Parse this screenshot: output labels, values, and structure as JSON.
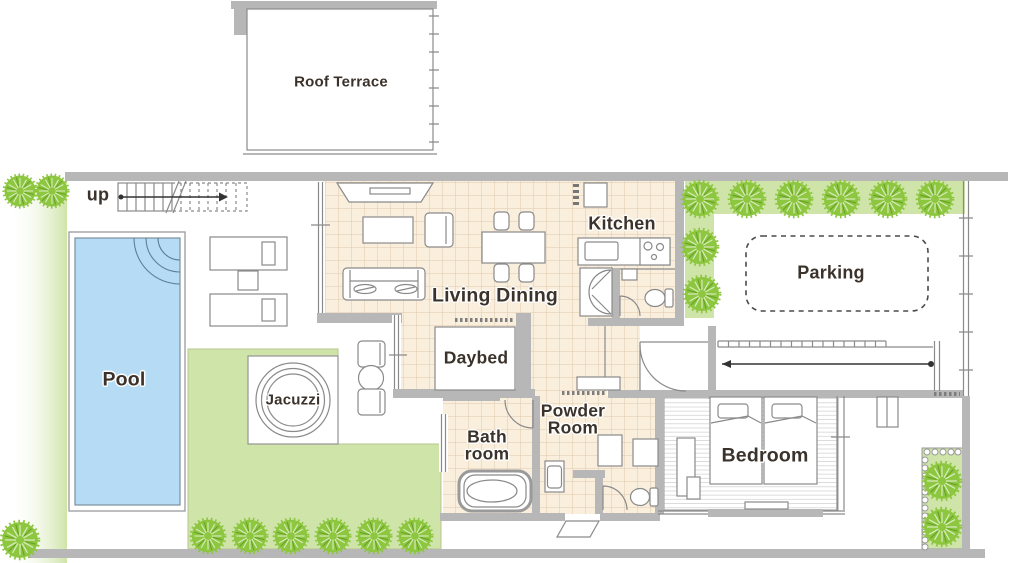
{
  "plan": {
    "labels": {
      "roof_terrace": "Roof Terrace",
      "up": "up",
      "pool": "Pool",
      "jacuzzi": "Jacuzzi",
      "living_dining": "Living Dining",
      "daybed": "Daybed",
      "kitchen": "Kitchen",
      "parking": "Parking",
      "bath_room_line1": "Bath",
      "bath_room_line2": "room",
      "powder_room_line1": "Powder",
      "powder_room_line2": "Room",
      "bedroom": "Bedroom"
    },
    "colors": {
      "wall": "#b7b7b7",
      "line": "#8a8a8a",
      "tile": "#faeedd",
      "tile_grid": "#ddc9af",
      "pool_water": "#b5dcf4",
      "lawn": "#cfe4a9",
      "tree": "#8dc63f",
      "label_text": "#3b332b"
    }
  }
}
